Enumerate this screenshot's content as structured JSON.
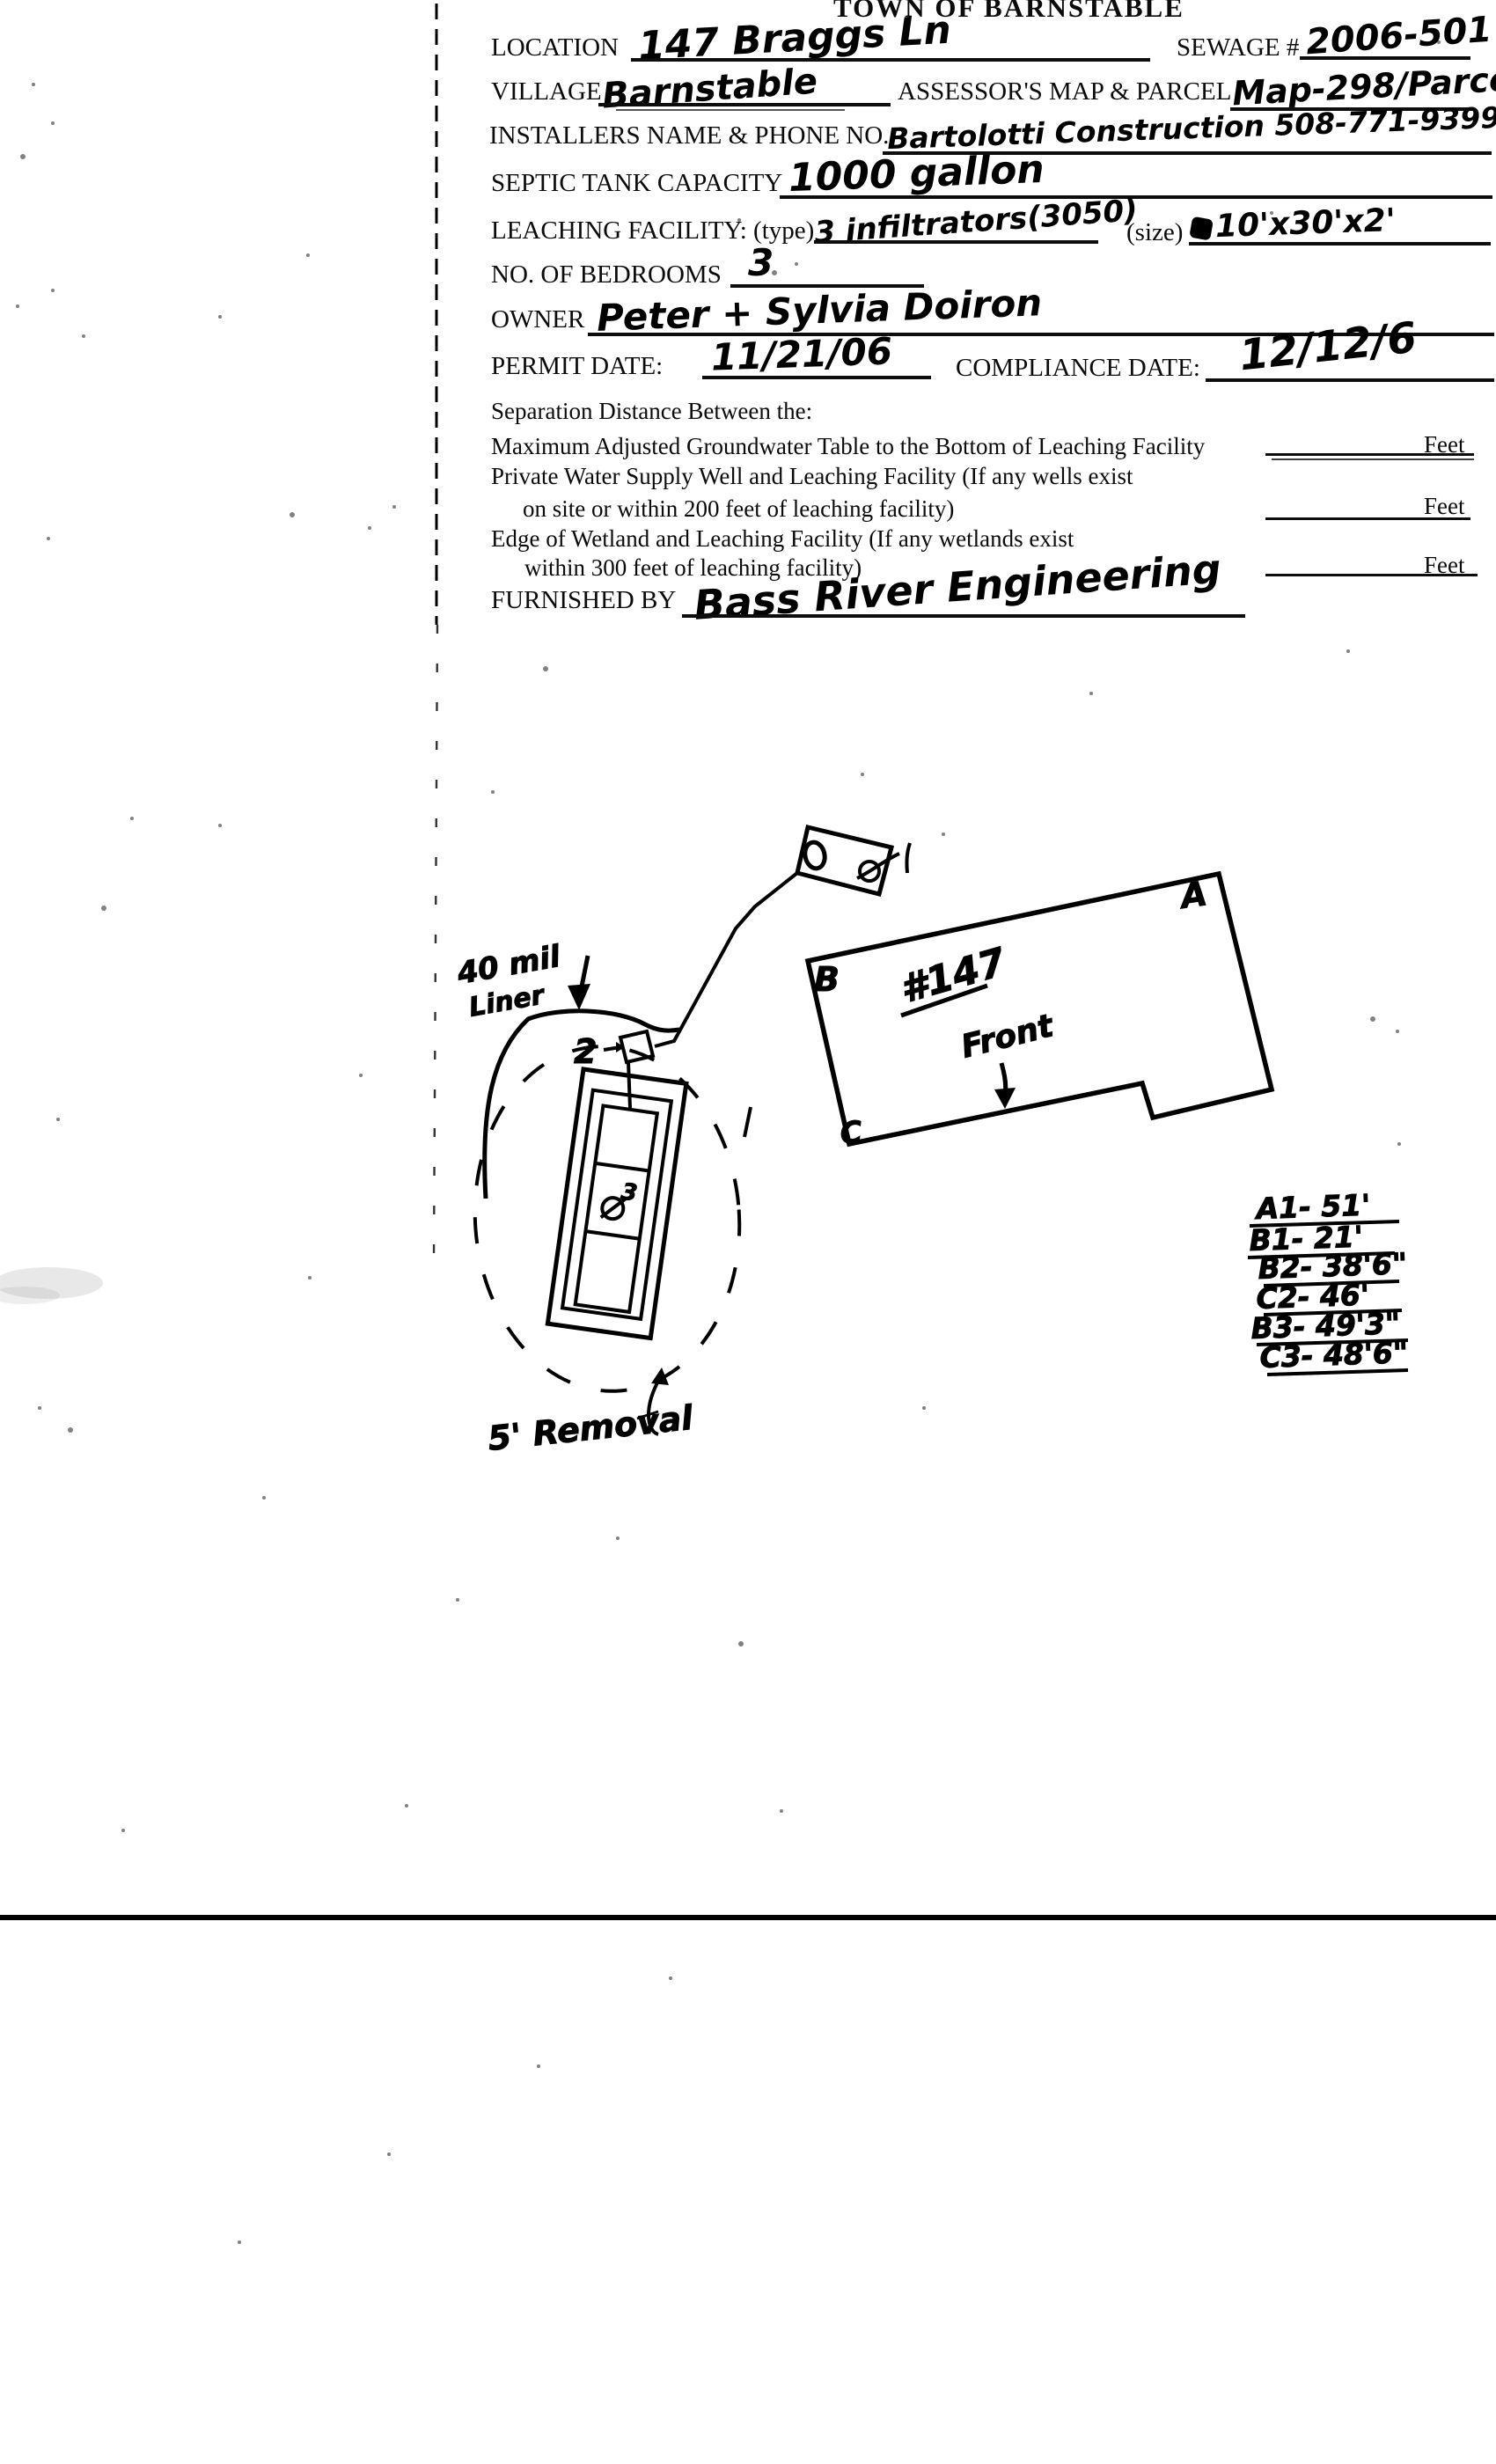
{
  "title": "TOWN OF BARNSTABLE",
  "form": {
    "location": {
      "label": "LOCATION",
      "value": "147 Braggs Ln"
    },
    "sewage": {
      "label": "SEWAGE #",
      "value": "2006-501"
    },
    "village": {
      "label": "VILLAGE",
      "value": "Barnstable"
    },
    "assessors": {
      "label": "ASSESSOR'S MAP & PARCEL",
      "value": "Map-298/Parcel 56"
    },
    "installer": {
      "label": "INSTALLERS NAME & PHONE NO.",
      "value": "Bartolotti Construction 508-771-9399"
    },
    "septic_capacity": {
      "label": "SEPTIC TANK CAPACITY",
      "value": "1000 gallon"
    },
    "leaching": {
      "label": "LEACHING FACILITY: (type)",
      "type_value": "3 infiltrators(3050)",
      "size_label": "(size)",
      "size_value": "10'x30'x2'"
    },
    "bedrooms": {
      "label": "NO. OF BEDROOMS",
      "value": "3"
    },
    "owner": {
      "label": "OWNER",
      "value": "Peter + Sylvia Doiron"
    },
    "permit_date": {
      "label": "PERMIT DATE:",
      "value": "11/21/06"
    },
    "compliance_date": {
      "label": "COMPLIANCE DATE:",
      "value": "12/12/6"
    },
    "separation_heading": "Separation Distance Between the:",
    "separation_rows": [
      {
        "text": "Maximum Adjusted Groundwater Table to the Bottom of Leaching Facility",
        "unit": "Feet"
      },
      {
        "text": "Private Water Supply Well and Leaching Facility (If any wells exist",
        "text2": "on site or within 200 feet of leaching facility)",
        "unit": "Feet"
      },
      {
        "text": "Edge of Wetland and Leaching Facility (If any wetlands exist",
        "text2": "within 300 feet of leaching facility)",
        "unit": "Feet"
      }
    ],
    "furnished_by": {
      "label": "FURNISHED BY",
      "value": "Bass River Engineering"
    }
  },
  "sketch": {
    "liner_label_line1": "40 mil",
    "liner_label_line2": "Liner",
    "dbox_label": "2",
    "infiltrator_label": "3",
    "well_label_o": "O",
    "well_point_label": "1",
    "house_number": "#147",
    "front_label": "Front",
    "corner_a": "A",
    "corner_b": "B",
    "corner_c": "C",
    "removal_label": "5' Removal",
    "measurements": [
      "A1- 51'",
      "B1- 21'",
      "B2- 38'6\"",
      "C2- 46'",
      "B3- 49'3\"",
      "C3- 48'6\""
    ]
  }
}
